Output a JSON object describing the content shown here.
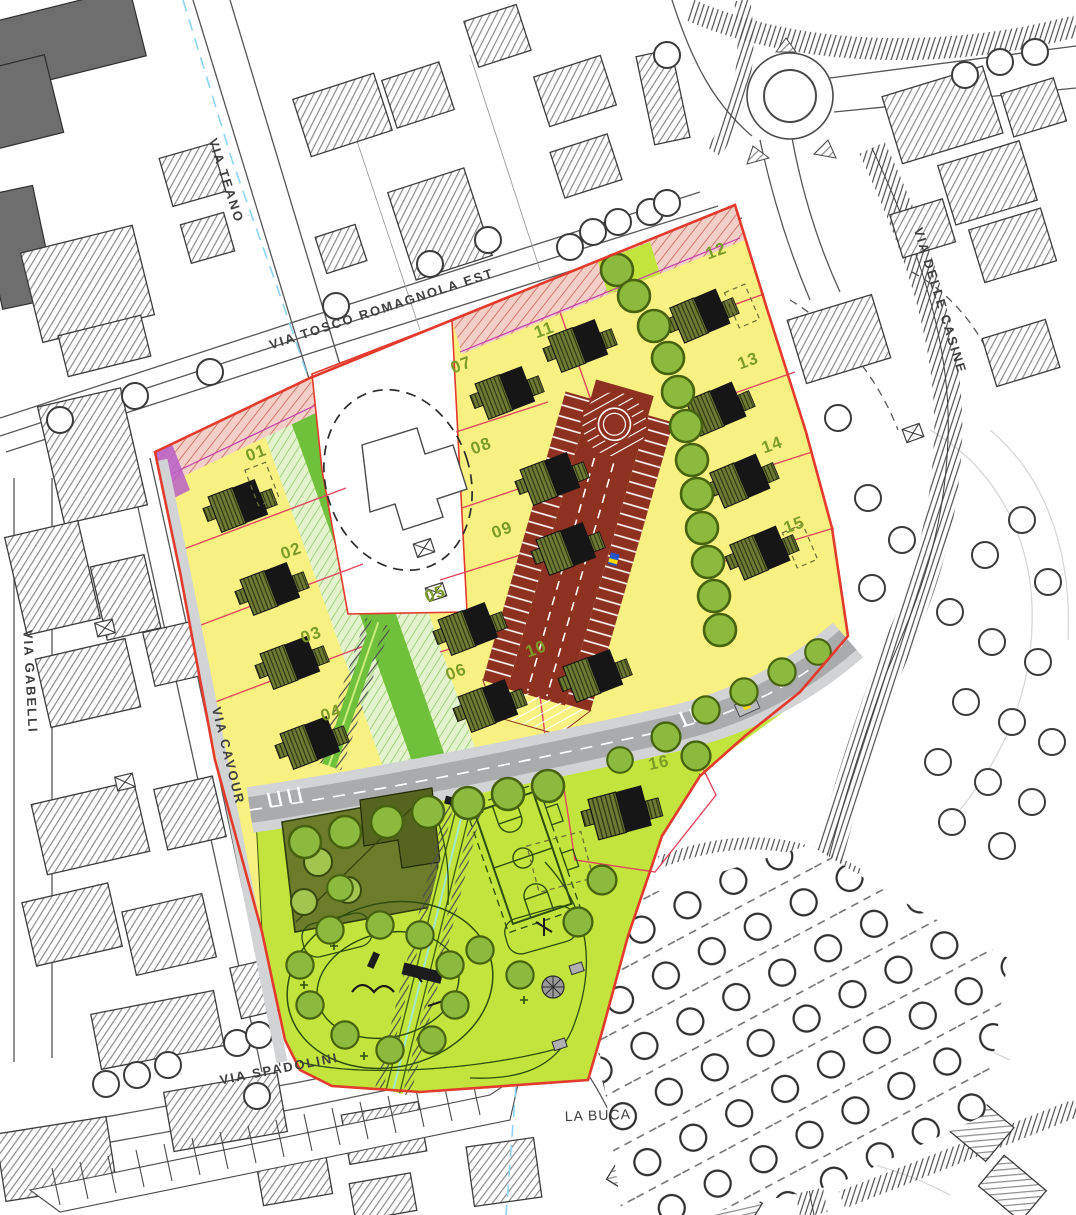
{
  "map": {
    "streets": {
      "via_teano": "VIA TEANO",
      "via_tosco_romagnola_est": "VIA TOSCO ROMAGNOLA EST",
      "via_gabelli": "VIA GABELLI",
      "via_cavour": "VIA CAVOUR",
      "via_spadolini": "VIA SPADOLINI",
      "via_delle_casine": "VIA DELLE CASINE"
    },
    "places": {
      "la_buca": "LA BUCA"
    },
    "lots": {
      "labels": [
        "01",
        "02",
        "03",
        "04",
        "05",
        "06",
        "07",
        "08",
        "09",
        "10",
        "11",
        "12",
        "13",
        "14",
        "15",
        "16"
      ]
    },
    "colors": {
      "lot-fill": "#f8f181",
      "lot-line": "#e0485f",
      "boundary": "#e23a2c",
      "setback-fill": "#f3cfc8",
      "setback-line": "#d0695c",
      "parking": "#8e3120",
      "road": "#a9abad",
      "sidewalk": "#d2d3d4",
      "park": "#c3e43c",
      "green-strip": "#6fc13c",
      "green-hatch-bg": "#e3f3cd",
      "green-hatch-ln": "#8cc763",
      "olive": "#6d7c2b",
      "olive-dark": "#55641f",
      "tree": "#8cba3e",
      "tree-dark": "#47630f",
      "purple": "#b95fc7",
      "number": "#7d9b27",
      "ink": "#3f3f3f",
      "water": "#8fd4f0",
      "court-line": "#2e4d10"
    }
  }
}
